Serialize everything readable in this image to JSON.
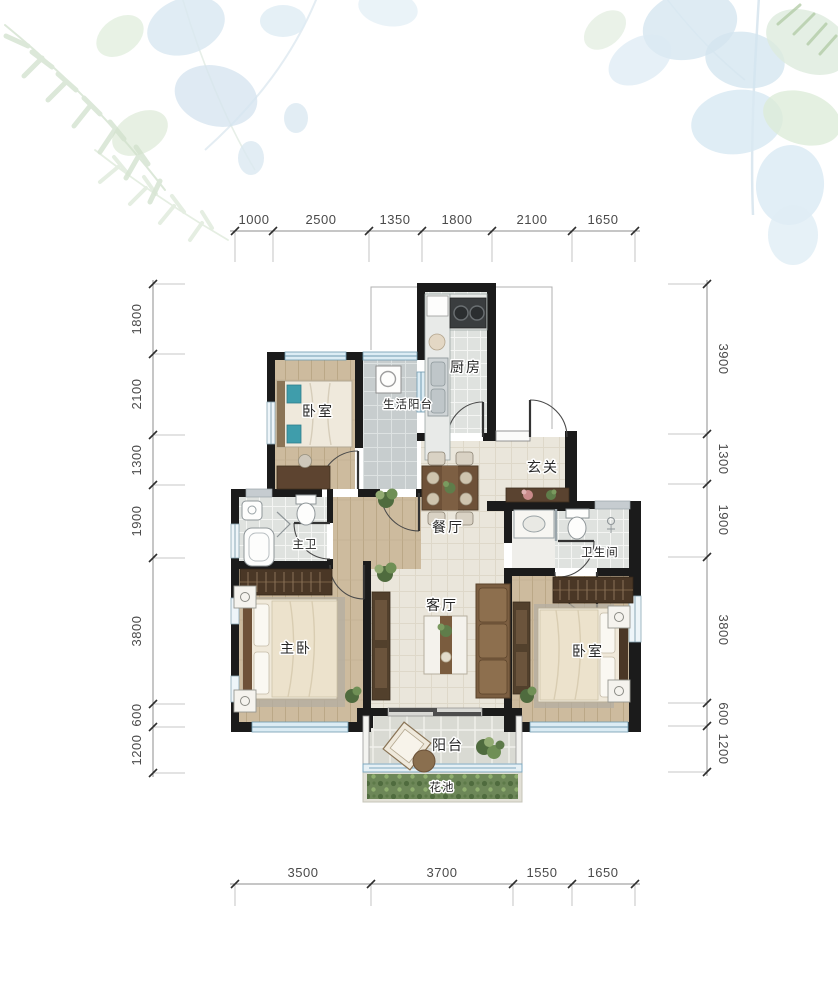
{
  "plan": {
    "rooms": {
      "kitchen": "厨房",
      "bedroom_top": "卧室",
      "service_balcony": "生活阳台",
      "entry": "玄关",
      "dining": "餐厅",
      "master_bath": "主卫",
      "bathroom": "卫生间",
      "master_bedroom": "主卧",
      "living": "客厅",
      "bedroom_right": "卧室",
      "balcony": "阳台",
      "flower_bed": "花池"
    },
    "dims": {
      "top": [
        "1000",
        "2500",
        "1350",
        "1800",
        "2100",
        "1650"
      ],
      "bottom": [
        "3500",
        "3700",
        "1550",
        "1650"
      ],
      "left": [
        "1800",
        "2100",
        "1300",
        "1900",
        "3800",
        "600",
        "1200"
      ],
      "right": [
        "3900",
        "1300",
        "1900",
        "3800",
        "600",
        "1200"
      ]
    },
    "colors": {
      "wall": "#1b1b1b",
      "wood_floor": "#cdbb9e",
      "tile_floor": "#dfe2df",
      "warm_tile": "#eae6db",
      "window_blue": "#bcd6e4",
      "plant_green": "#5f7d4a",
      "flower_bed_green": "#6d8758",
      "teal_pillow": "#3f9dab",
      "furniture_wood": "#5d4430"
    }
  }
}
